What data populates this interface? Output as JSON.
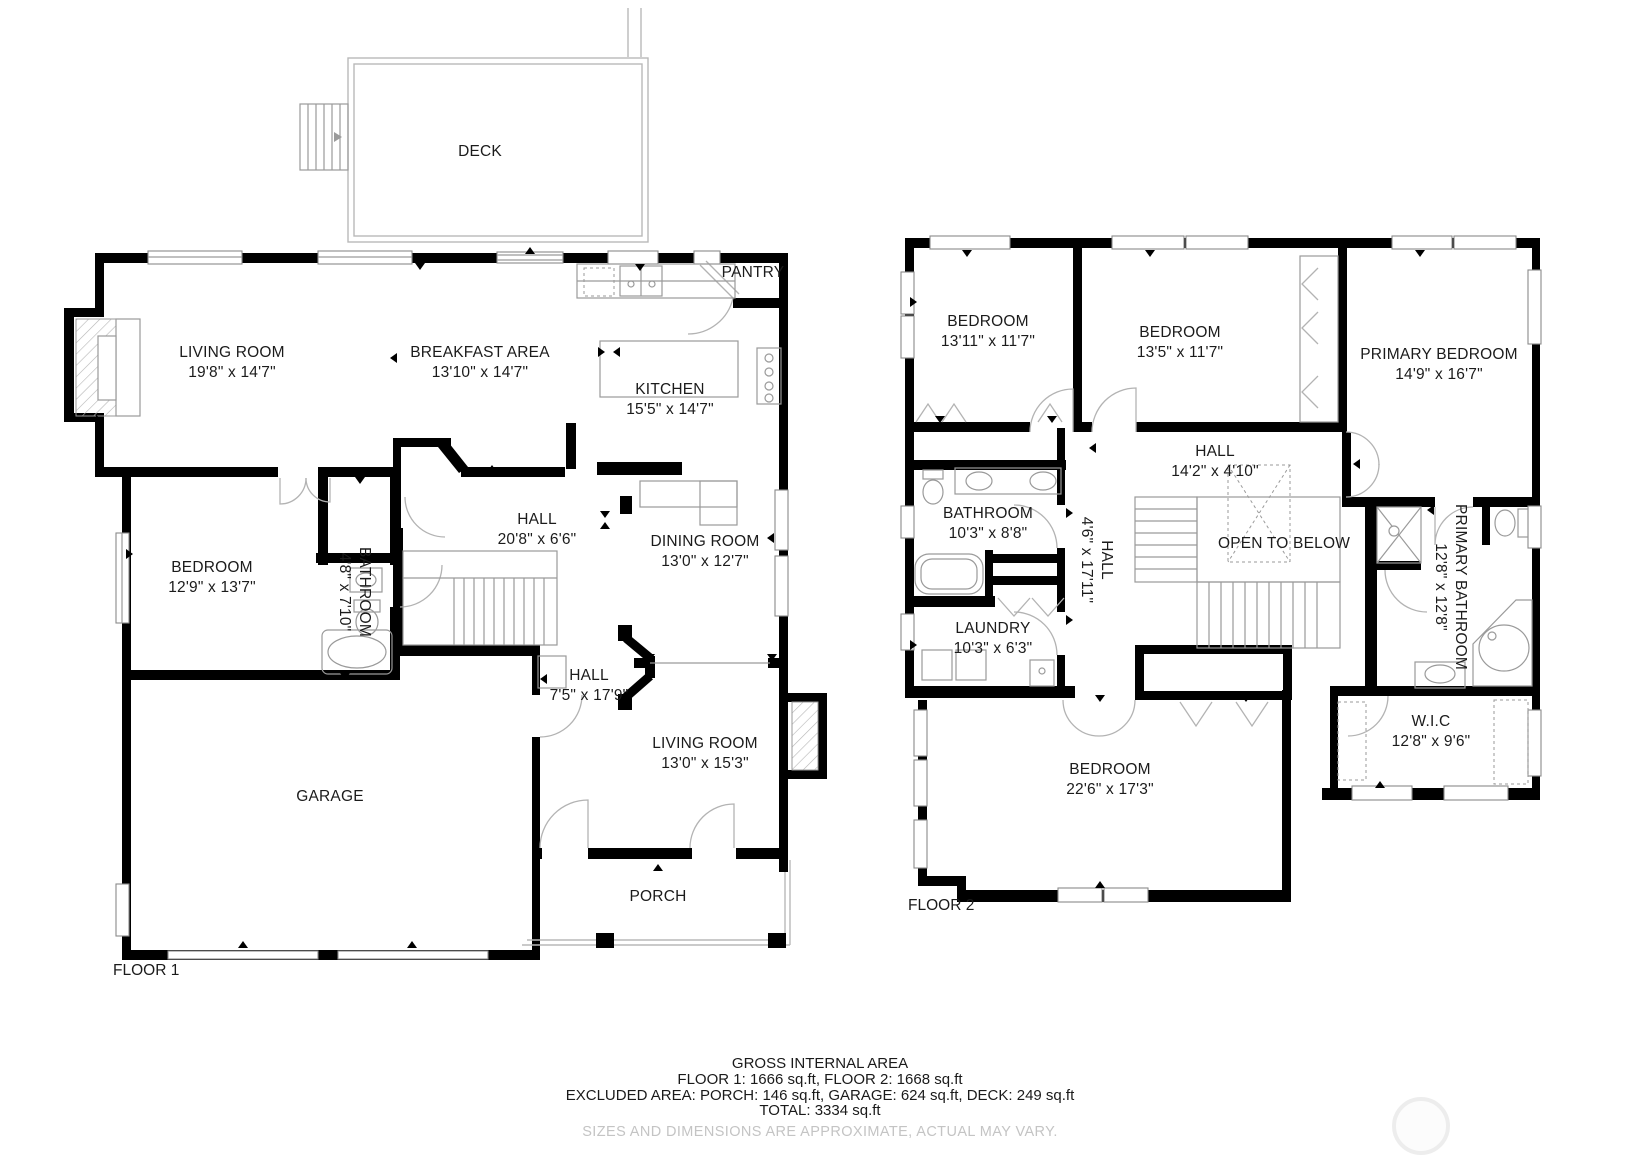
{
  "floor1": {
    "title": "FLOOR 1",
    "rooms": [
      {
        "name": "DECK",
        "dims": ""
      },
      {
        "name": "LIVING ROOM",
        "dims": "19'8\" x 14'7\""
      },
      {
        "name": "BREAKFAST AREA",
        "dims": "13'10\" x 14'7\""
      },
      {
        "name": "KITCHEN",
        "dims": "15'5\" x 14'7\""
      },
      {
        "name": "PANTRY",
        "dims": ""
      },
      {
        "name": "HALL",
        "dims": "20'8\" x 6'6\""
      },
      {
        "name": "BEDROOM",
        "dims": "12'9\" x 13'7\""
      },
      {
        "name": "BATHROOM",
        "dims": "4'8\" x 7'10\""
      },
      {
        "name": "DINING ROOM",
        "dims": "13'0\" x 12'7\""
      },
      {
        "name": "HALL",
        "dims": "7'5\" x 17'9\""
      },
      {
        "name": "GARAGE",
        "dims": ""
      },
      {
        "name": "LIVING ROOM",
        "dims": "13'0\" x 15'3\""
      },
      {
        "name": "PORCH",
        "dims": ""
      }
    ]
  },
  "floor2": {
    "title": "FLOOR 2",
    "rooms": [
      {
        "name": "BEDROOM",
        "dims": "13'11\" x 11'7\""
      },
      {
        "name": "BEDROOM",
        "dims": "13'5\" x 11'7\""
      },
      {
        "name": "PRIMARY BEDROOM",
        "dims": "14'9\" x 16'7\""
      },
      {
        "name": "HALL",
        "dims": "14'2\" x 4'10\""
      },
      {
        "name": "BATHROOM",
        "dims": "10'3\" x 8'8\""
      },
      {
        "name": "HALL",
        "dims": "4'6\" x 17'11\""
      },
      {
        "name": "OPEN TO BELOW",
        "dims": ""
      },
      {
        "name": "LAUNDRY",
        "dims": "10'3\" x 6'3\""
      },
      {
        "name": "PRIMARY BATHROOM",
        "dims": "12'8\" x 12'8\""
      },
      {
        "name": "W.I.C",
        "dims": "12'8\" x 9'6\""
      },
      {
        "name": "BEDROOM",
        "dims": "22'6\" x 17'3\""
      }
    ]
  },
  "summary": {
    "heading": "GROSS INTERNAL AREA",
    "floors_line": "FLOOR 1: 1666 sq.ft, FLOOR 2: 1668 sq.ft",
    "excluded_line": "EXCLUDED AREA: PORCH: 146 sq.ft, GARAGE: 624 sq.ft, DECK: 249 sq.ft",
    "total_line": "TOTAL: 3334 sq.ft",
    "disclaimer": "SIZES AND DIMENSIONS ARE APPROXIMATE, ACTUAL MAY VARY."
  },
  "colors": {
    "wall": "#000000",
    "fixture_line": "#9a9a9a",
    "window_line": "#8a8a8a",
    "label_text": "#1b1b1b",
    "disclaimer_text": "#c4c4c4"
  }
}
